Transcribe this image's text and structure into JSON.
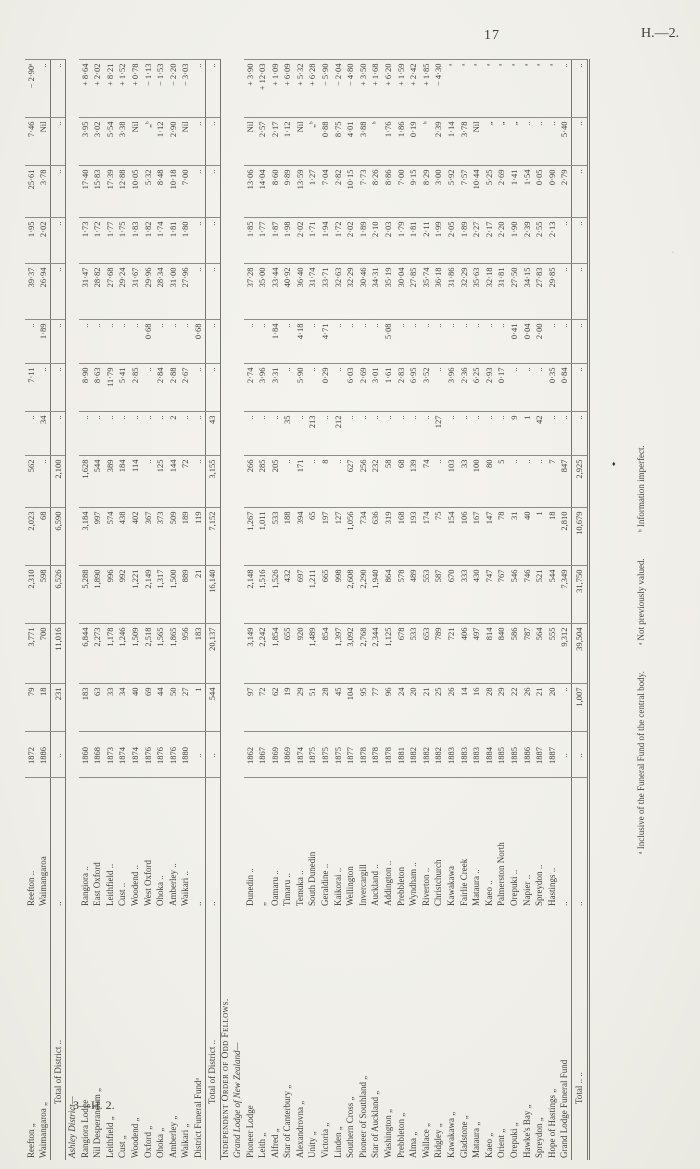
{
  "page": {
    "number": "17",
    "heading": "H.—2.",
    "signature": "3—H. 2."
  },
  "footnotes": {
    "f1": "ᵃ Inclusive of the Funeral Fund of the central body.",
    "f2": "ᵃ Not previously valued.",
    "f3": "ᵇ Information imperfect."
  },
  "artifacts": {
    "mark1": "♦",
    "mark2": "·"
  },
  "table": {
    "rows": [
      {
        "type": "lodge",
        "cells": [
          "Reefton „",
          "Reefton ..",
          "1872",
          "79",
          "3,771",
          "2,310",
          "2,023",
          "562",
          "..",
          "7·11",
          "..",
          "39·37",
          "1·95",
          "25·61",
          "7·46",
          "− 2·90ᵃ"
        ]
      },
      {
        "type": "lodge",
        "cells": [
          "Waimangaroa „",
          "Waimangaroa",
          "1886",
          "18",
          "700",
          "598",
          "68",
          "..",
          "34",
          "..",
          "1·89",
          "26·94",
          "2·02",
          "3·78",
          "Nil",
          ".."
        ]
      },
      {
        "type": "total",
        "cells": [
          "Total of District ..",
          "..",
          "..",
          "231",
          "11,016",
          "6,526",
          "6,590",
          "2,100",
          "..",
          "..",
          "..",
          "..",
          "..",
          "..",
          "..",
          ".."
        ]
      },
      {
        "type": "section",
        "line1": "",
        "line2": "Ashley District—"
      },
      {
        "type": "lodge",
        "cells": [
          "Rangiora Lodge",
          "Rangiora ..",
          "1860",
          "183",
          "6,844",
          "5,288",
          "3,184",
          "1,628",
          "..",
          "8·90",
          "..",
          "31·47",
          "1·73",
          "17·40",
          "3·95",
          "+ 8·64"
        ]
      },
      {
        "type": "lodge",
        "cells": [
          "Nil Desperandum „",
          "East Oxford",
          "1868",
          "63",
          "2,273",
          "1,890",
          "997",
          "544",
          "..",
          "8·63",
          "..",
          "28·82",
          "1·72",
          "15·83",
          "3·02",
          "+ 2·02"
        ]
      },
      {
        "type": "lodge",
        "cells": [
          "Leithfield „",
          "Leithfield ..",
          "1873",
          "33",
          "1,178",
          "996",
          "574",
          "389",
          "..",
          "11·79",
          "..",
          "27·68",
          "1·77",
          "17·39",
          "5·54",
          "+ 8·21"
        ]
      },
      {
        "type": "lodge",
        "cells": [
          "Cust „",
          "Cust ..",
          "1874",
          "34",
          "1,246",
          "992",
          "438",
          "184",
          "..",
          "5·41",
          "..",
          "29·24",
          "1·75",
          "12·88",
          "3·38",
          "+ 1·52"
        ]
      },
      {
        "type": "lodge",
        "cells": [
          "Woodend „",
          "Woodend ..",
          "1874",
          "40",
          "1,509",
          "1,221",
          "402",
          "114",
          "..",
          "2·85",
          "..",
          "31·67",
          "1·83",
          "10·05",
          "Nil",
          "+ 0·78"
        ]
      },
      {
        "type": "lodge",
        "cells": [
          "Oxford „",
          "West Oxford",
          "1876",
          "69",
          "2,518",
          "2,149",
          "367",
          "..",
          "..",
          "..",
          "0·68",
          "29·96",
          "1·82",
          "5·32",
          "„ᵇ",
          "− 1·13"
        ]
      },
      {
        "type": "lodge",
        "cells": [
          "Ohoka „",
          "Ohoka ..",
          "1876",
          "44",
          "1,565",
          "1,317",
          "373",
          "125",
          "..",
          "2·84",
          "..",
          "28·34",
          "1·74",
          "8·48",
          "1·12",
          "− 1·53"
        ]
      },
      {
        "type": "lodge",
        "cells": [
          "Amberley „",
          "Amberley ..",
          "1876",
          "50",
          "1,865",
          "1,500",
          "509",
          "144",
          "2",
          "2·88",
          "..",
          "31·00",
          "1·81",
          "10·18",
          "2·90",
          "− 2·20"
        ]
      },
      {
        "type": "lodge",
        "cells": [
          "Waikari „",
          "Waikari ..",
          "1880",
          "27",
          "956",
          "889",
          "189",
          "72",
          "..",
          "2·67",
          "..",
          "27·96",
          "1·80",
          "7·00",
          "Nil",
          "− 3·03"
        ]
      },
      {
        "type": "lodge",
        "cells": [
          "District Funeral Fundᵃ",
          "..",
          "..",
          "1",
          "183",
          "21",
          "119",
          "..",
          "..",
          "..",
          "0·68",
          "..",
          "..",
          "..",
          "..",
          ".."
        ]
      },
      {
        "type": "total",
        "cells": [
          "Total of District ..",
          "..",
          "..",
          "544",
          "20,137",
          "16,140",
          "7,152",
          "3,155",
          "43",
          "..",
          "..",
          "..",
          "..",
          "..",
          "..",
          ".."
        ]
      },
      {
        "type": "section",
        "line1": "Independent Order of Odd Fellows.",
        "line2": "Grand Lodge of New Zealand—"
      },
      {
        "type": "lodge",
        "cells": [
          "Pioneer Lodge",
          "Dunedin ..",
          "1862",
          "97",
          "3,149",
          "2,148",
          "1,267",
          "266",
          "..",
          "2·74",
          "..",
          "37·28",
          "1·85",
          "13·06",
          "Nil",
          "+ 3·90"
        ]
      },
      {
        "type": "lodge",
        "cells": [
          "Leith „",
          "„",
          "1867",
          "72",
          "2,242",
          "1,516",
          "1,011",
          "285",
          "..",
          "3·96",
          "..",
          "35·00",
          "1·77",
          "14·04",
          "2·57",
          "+ 12·03"
        ]
      },
      {
        "type": "lodge",
        "cells": [
          "Alfred „",
          "Oamaru ..",
          "1869",
          "62",
          "1,854",
          "1,526",
          "533",
          "205",
          "..",
          "3·31",
          "1·84",
          "33·44",
          "1·87",
          "8·60",
          "2·17",
          "+ 1·09"
        ]
      },
      {
        "type": "lodge",
        "cells": [
          "Star of Canterbury „",
          "Timaru ..",
          "1869",
          "19",
          "655",
          "432",
          "188",
          "..",
          "35",
          "..",
          "..",
          "40·92",
          "1·98",
          "9·89",
          "1·12",
          "+ 6·09"
        ]
      },
      {
        "type": "lodge",
        "cells": [
          "Alexandrovna „",
          "Temuka ..",
          "1874",
          "29",
          "920",
          "697",
          "394",
          "171",
          "..",
          "5·90",
          "4·18",
          "36·40",
          "2·02",
          "13·59",
          "Nil",
          "+ 5·32"
        ]
      },
      {
        "type": "lodge",
        "cells": [
          "Unity „",
          "South Dunedin",
          "1875",
          "51",
          "1,489",
          "1,211",
          "65",
          "..",
          "213",
          "..",
          "..",
          "31·74",
          "1·71",
          "1·27",
          "„ᵇ",
          "+ 6·28"
        ]
      },
      {
        "type": "lodge",
        "cells": [
          "Victoria „",
          "Geraldine ..",
          "1875",
          "28",
          "854",
          "665",
          "197",
          "8",
          "..",
          "0·29",
          "4·71",
          "33·71",
          "1·94",
          "7·04",
          "0·88",
          "− 5·90"
        ]
      },
      {
        "type": "lodge",
        "cells": [
          "Linden „",
          "Kaikorai ..",
          "1875",
          "45",
          "1,397",
          "998",
          "127",
          "..",
          "212",
          "..",
          "..",
          "32·63",
          "1·72",
          "2·82",
          "8·75",
          "− 2·04"
        ]
      },
      {
        "type": "lodge",
        "cells": [
          "Southern Cross „",
          "Wellington",
          "1877",
          "104",
          "3,092",
          "2,608",
          "1,056",
          "627",
          "..",
          "6·03",
          "..",
          "32·29",
          "2·02",
          "10·15",
          "4·01",
          "− 4·80"
        ]
      },
      {
        "type": "lodge",
        "cells": [
          "Pioneer of Southland „",
          "Invercargill",
          "1878",
          "95",
          "2,768",
          "2,290",
          "734",
          "256",
          "..",
          "2·69",
          "..",
          "30·46",
          "1·89",
          "7·73",
          "3·88",
          "+ 3·50"
        ]
      },
      {
        "type": "lodge",
        "cells": [
          "Star of Auckland „",
          "Auckland ..",
          "1878",
          "77",
          "2,344",
          "1,940",
          "636",
          "232",
          "..",
          "3·01",
          "..",
          "34·31",
          "2·10",
          "8·26",
          "ᵇ",
          "+ 1·68"
        ]
      },
      {
        "type": "lodge",
        "cells": [
          "Washington „",
          "Addington ..",
          "1878",
          "96",
          "1,125",
          "864",
          "319",
          "58",
          "..",
          "1·61",
          "5·08",
          "35·19",
          "2·03",
          "8·86",
          "1·76",
          "+ 6·20"
        ]
      },
      {
        "type": "lodge",
        "cells": [
          "Prebbleton „",
          "Prebbleton",
          "1881",
          "24",
          "678",
          "578",
          "168",
          "68",
          "..",
          "2·83",
          "..",
          "30·04",
          "1·79",
          "7·00",
          "1·86",
          "+ 1·59"
        ]
      },
      {
        "type": "lodge",
        "cells": [
          "Alma „",
          "Wyndham ..",
          "1882",
          "20",
          "533",
          "489",
          "193",
          "139",
          "..",
          "6·95",
          "..",
          "27·85",
          "1·81",
          "9·15",
          "0·19",
          "+ 2·42"
        ]
      },
      {
        "type": "lodge",
        "cells": [
          "Wallace „",
          "Riverton ..",
          "1882",
          "21",
          "653",
          "553",
          "174",
          "74",
          "..",
          "3·52",
          "..",
          "35·74",
          "2·11",
          "8·29",
          "ᵇ",
          "+ 1·85"
        ]
      },
      {
        "type": "lodge",
        "cells": [
          "Ridgley „",
          "Christchurch",
          "1882",
          "25",
          "789",
          "587",
          "75",
          "..",
          "127",
          "..",
          "..",
          "36·18",
          "1·99",
          "3·00",
          "2·39",
          "− 4·30"
        ]
      },
      {
        "type": "lodge",
        "cells": [
          "Kawakawa „",
          "Kawakawa",
          "1883",
          "26",
          "721",
          "670",
          "154",
          "103",
          "..",
          "3·96",
          "..",
          "31·86",
          "2·05",
          "5·92",
          "1·14",
          "ᵃ"
        ]
      },
      {
        "type": "lodge",
        "cells": [
          "Gladstone „",
          "Fairlie Creek",
          "1883",
          "14",
          "406",
          "333",
          "106",
          "33",
          "..",
          "2·36",
          "..",
          "32·29",
          "1·89",
          "7·57",
          "3·78",
          "ᵃ"
        ]
      },
      {
        "type": "lodge",
        "cells": [
          "Mataura „",
          "Mataura ..",
          "1883",
          "16",
          "497",
          "430",
          "167",
          "100",
          "..",
          "6·25",
          "..",
          "35·63",
          "2·27",
          "10·44",
          "Nil",
          "ᵃ"
        ]
      },
      {
        "type": "lodge",
        "cells": [
          "Kaeo „",
          "Kaeo ..",
          "1884",
          "28",
          "814",
          "747",
          "147",
          "80",
          "..",
          "2·93",
          "..",
          "32·18",
          "2·17",
          "5·25",
          "„",
          "ᵃ"
        ]
      },
      {
        "type": "lodge",
        "cells": [
          "Orient „",
          "Palmerston North",
          "1885",
          "29",
          "840",
          "767",
          "78",
          "5",
          "..",
          "0·17",
          "..",
          "31·81",
          "2·20",
          "2·69",
          "„",
          "ᵃ"
        ]
      },
      {
        "type": "lodge",
        "cells": [
          "Orepuki „",
          "Orepuki ..",
          "1885",
          "22",
          "586",
          "546",
          "31",
          "..",
          "9",
          "..",
          "0·41",
          "27·50",
          "1·90",
          "1·41",
          "„",
          "ᵃ"
        ]
      },
      {
        "type": "lodge",
        "cells": [
          "Hawke's Bay „",
          "Napier ..",
          "1886",
          "26",
          "787",
          "746",
          "40",
          "..",
          "1",
          "..",
          "0·04",
          "34·15",
          "2·39",
          "1·54",
          "..",
          "ᵃ"
        ]
      },
      {
        "type": "lodge",
        "cells": [
          "Spreydon „",
          "Spreydon ..",
          "1887",
          "21",
          "564",
          "521",
          "1",
          "..",
          "42",
          "..",
          "2·00",
          "27·83",
          "2·55",
          "0·05",
          "..",
          "ᵃ"
        ]
      },
      {
        "type": "lodge",
        "cells": [
          "Hope of Hastings „",
          "Hastings ..",
          "1887",
          "20",
          "555",
          "544",
          "18",
          "7",
          "..",
          "0·35",
          "..",
          "29·85",
          "2·13",
          "0·90",
          "..",
          "ᵃ"
        ]
      },
      {
        "type": "lodge",
        "cells": [
          "Grand Lodge Funeral Fund",
          "..",
          "..",
          "..",
          "9,312",
          "7,349",
          "2,810",
          "847",
          "..",
          "0·84",
          "..",
          "..",
          "..",
          "2·79",
          "5·40",
          ".."
        ]
      },
      {
        "type": "gtotal",
        "cells": [
          "Total ..      ..",
          "..",
          "..",
          "1,007",
          "39,504",
          "31,750",
          "10,679",
          "2,925",
          "..",
          "..",
          "..",
          "..",
          "..",
          "..",
          "..",
          ".."
        ]
      }
    ]
  }
}
